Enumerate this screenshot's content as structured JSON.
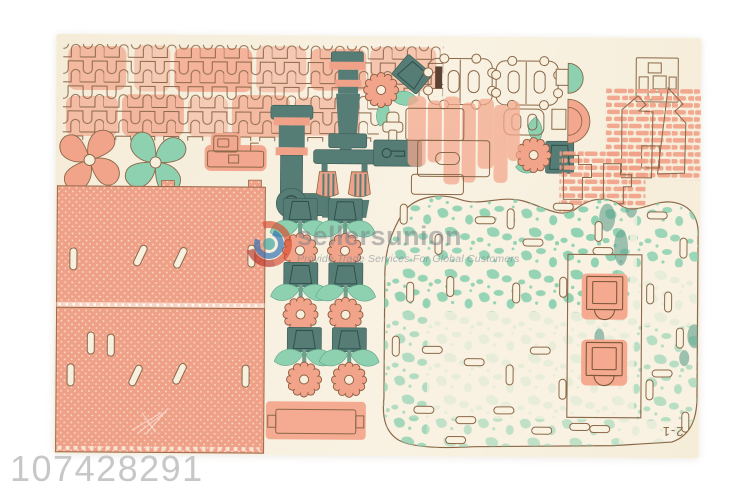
{
  "product_id": "107428291",
  "watermark": {
    "brand": "sellersunion",
    "tagline": "Provide Trade Services For Global Customers"
  },
  "board": {
    "sheet_label": "2-1",
    "description": "Laser-cut wooden 3D puzzle sheet (windmill farm kit) printed in salmon and teal on cream plywood",
    "pieces": [
      "caterpillar-track-strips",
      "pinwheel-pink",
      "pinwheel-mint",
      "tractor-piece",
      "lattice-roof-panels",
      "crane-arm",
      "tower-piece",
      "gear-bracket",
      "flower-pot-units",
      "connector-pieces",
      "keyhole-pieces",
      "half-dome-pieces",
      "squares-connector",
      "brick-chimney-clusters",
      "mottled-base-plate",
      "arch-door-frames",
      "plank-piece"
    ]
  },
  "palette": {
    "background": "#ffffff",
    "board_cream": "#f7efdc",
    "salmon": "#f2a48b",
    "dark_teal": "#567c76",
    "mint": "#8ed1b1",
    "outline_brown": "#8a6848",
    "id_text_gray": "#c7c7c7",
    "logo_red": "#d94b2f",
    "logo_blue": "#2f6fb5"
  }
}
